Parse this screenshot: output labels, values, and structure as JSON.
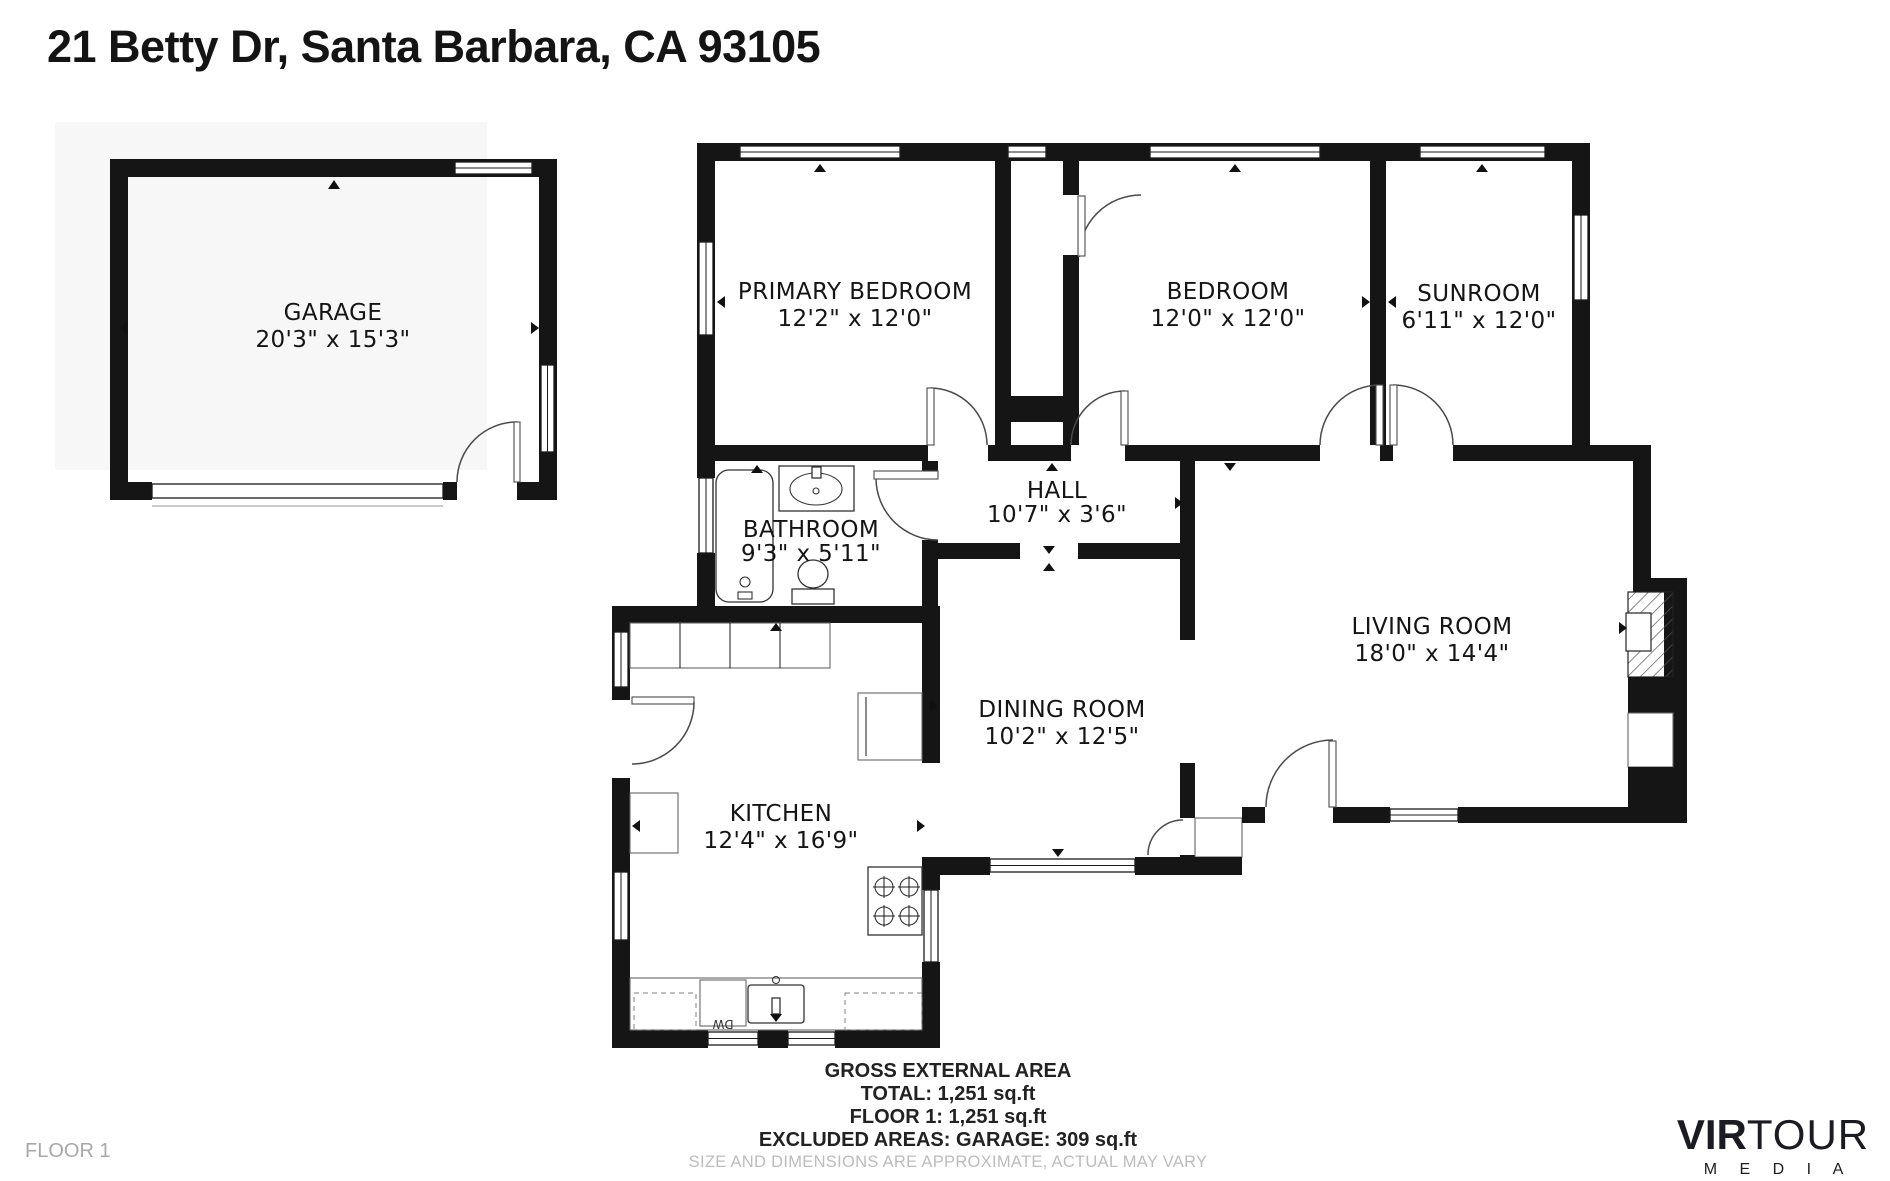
{
  "title": "21 Betty Dr, Santa Barbara, CA 93105",
  "floor_label": "FLOOR 1",
  "rooms": {
    "garage": {
      "name": "GARAGE",
      "dims": "20'3\" x 15'3\""
    },
    "primary_bedroom": {
      "name": "PRIMARY BEDROOM",
      "dims": "12'2\" x 12'0\""
    },
    "bedroom": {
      "name": "BEDROOM",
      "dims": "12'0\" x 12'0\""
    },
    "sunroom": {
      "name": "SUNROOM",
      "dims": "6'11\" x 12'0\""
    },
    "hall": {
      "name": "HALL",
      "dims": "10'7\" x 3'6\""
    },
    "bathroom": {
      "name": "BATHROOM",
      "dims": "9'3\" x 5'11\""
    },
    "living_room": {
      "name": "LIVING ROOM",
      "dims": "18'0\" x 14'4\""
    },
    "dining_room": {
      "name": "DINING ROOM",
      "dims": "10'2\" x 12'5\""
    },
    "kitchen": {
      "name": "KITCHEN",
      "dims": "12'4\" x 16'9\""
    }
  },
  "fixtures": {
    "dishwasher_label": "DW"
  },
  "area_summary": {
    "heading": "GROSS EXTERNAL AREA",
    "total": "TOTAL: 1,251 sq.ft",
    "floor1": "FLOOR 1: 1,251 sq.ft",
    "excluded": "EXCLUDED AREAS: GARAGE: 309 sq.ft",
    "disclaimer": "SIZE AND DIMENSIONS ARE APPROXIMATE, ACTUAL MAY VARY"
  },
  "logo": {
    "brand_bold": "VIR",
    "brand_light": "TOUR",
    "subtitle": "M E D I A"
  },
  "colors": {
    "wall": "#151515",
    "muted_text": "#bcbcbc",
    "floor_label_text": "#a8a8a8"
  }
}
